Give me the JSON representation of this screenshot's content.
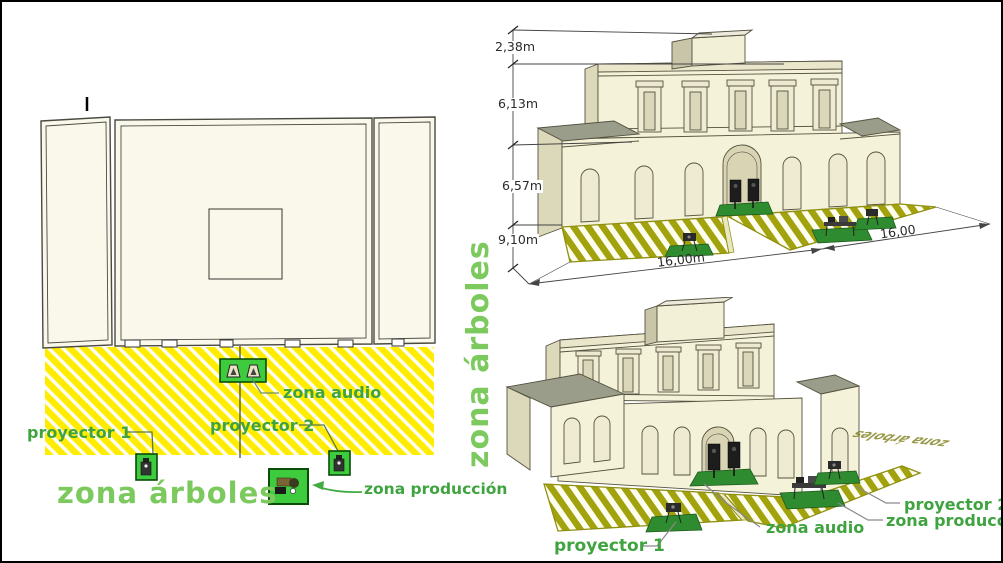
{
  "plan": {
    "labels": {
      "zona_audio": "zona audio",
      "proyector_1": "proyector 1",
      "proyector_2": "proyector 2",
      "zona_arboles": "zona árboles",
      "zona_arboles_vertical": "zona árboles",
      "zona_produccion": "zona producción"
    }
  },
  "dimensioned_view": {
    "height_roof_box": "2,38m",
    "height_upper_floor": "6,13m",
    "height_lower_floor": "6,57m",
    "ground_depth": "9,10m",
    "width_front": "16,00m",
    "width_side": "16,00"
  },
  "labeled_view": {
    "proyector_1": "proyector 1",
    "zona_audio": "zona audio",
    "proyector_2": "proyector 2",
    "zona_produccion": "zona producción",
    "ground_text": "zona árboles"
  },
  "icons": {
    "speaker-icon": "trapezoid loudspeaker glyph",
    "projector-icon": "small dark projector box on legs",
    "production-table-icon": "production desk with gear",
    "arrow-icon": "green leader arrowhead",
    "dimension-tick-icon": "architectural slash tick"
  },
  "colors": {
    "label_green": "#3fa43f",
    "zone_text_green": "#7cc95e",
    "hatch_yellow": "#ffec00",
    "hatch_olive": "#a2a20c",
    "equipment_box_green": "#3ecc3e",
    "ground_patch_green": "#2f8b2f",
    "wall_cream": "#f5f2da",
    "roof_gray": "#9a9d8a"
  }
}
